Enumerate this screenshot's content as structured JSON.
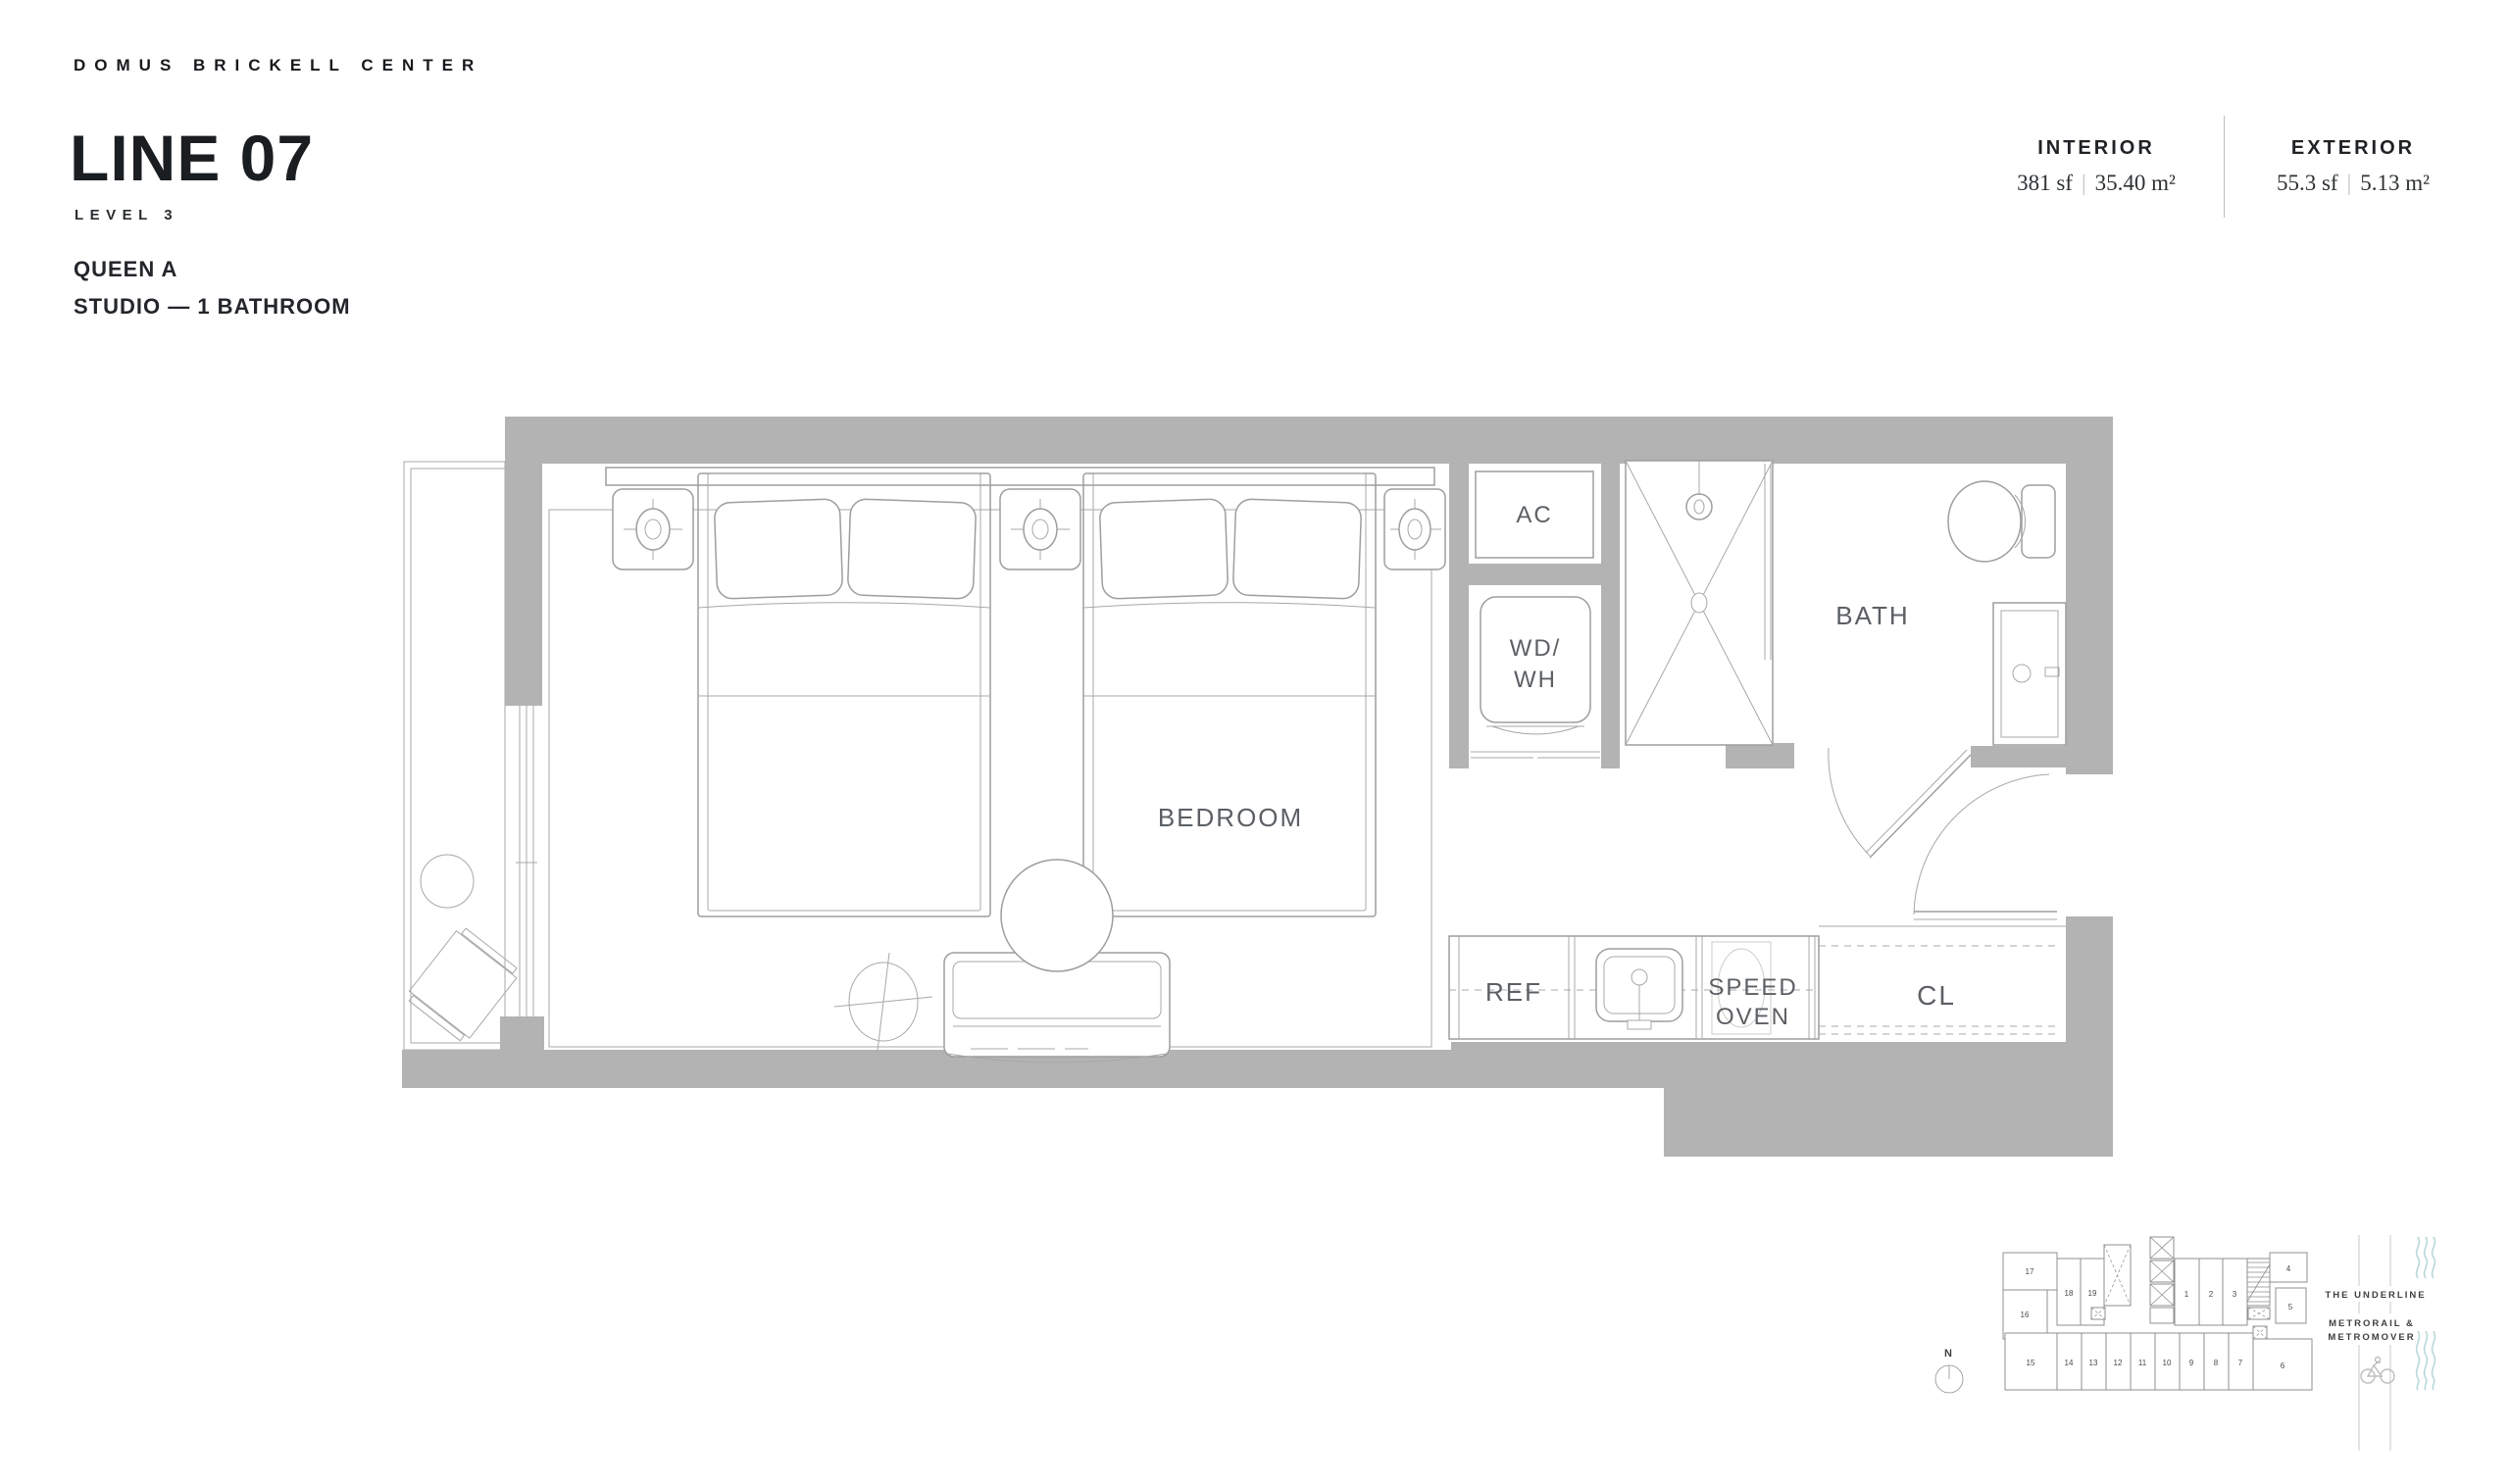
{
  "header": {
    "brand": "DOMUS BRICKELL CENTER",
    "title": "LINE 07",
    "level": "LEVEL 3",
    "unit_name": "QUEEN A",
    "unit_type": "STUDIO — 1 BATHROOM"
  },
  "stats": {
    "separator": "|",
    "interior": {
      "label": "INTERIOR",
      "sf": "381 sf",
      "m2": "35.40 m²"
    },
    "exterior": {
      "label": "EXTERIOR",
      "sf": "55.3 sf",
      "m2": "5.13 m²"
    }
  },
  "floorplan": {
    "labels": {
      "bedroom": "BEDROOM",
      "ac": "AC",
      "wd": "WD/",
      "wh": "WH",
      "bath": "BATH",
      "ref": "REF",
      "speed": "SPEED",
      "oven": "OVEN",
      "cl": "CL"
    }
  },
  "keyplan": {
    "north": "N",
    "highlighted_unit": "7",
    "units": {
      "u1": "1",
      "u2": "2",
      "u3": "3",
      "u4": "4",
      "u5": "5",
      "u6": "6",
      "u7": "7",
      "u8": "8",
      "u9": "9",
      "u10": "10",
      "u11": "11",
      "u12": "12",
      "u13": "13",
      "u14": "14",
      "u15": "15",
      "u16": "16",
      "u17": "17",
      "u18": "18",
      "u19": "19"
    },
    "landmarks": {
      "underline": "THE UNDERLINE",
      "transit1": "METRORAIL &",
      "transit2": "METROMOVER"
    }
  },
  "colors": {
    "wall": "#b3b3b3",
    "plan_line": "#9e9e9e",
    "label": "#5c6064",
    "unit_highlight": "#dce9f1",
    "wave_teal": "#b9d8d8"
  }
}
